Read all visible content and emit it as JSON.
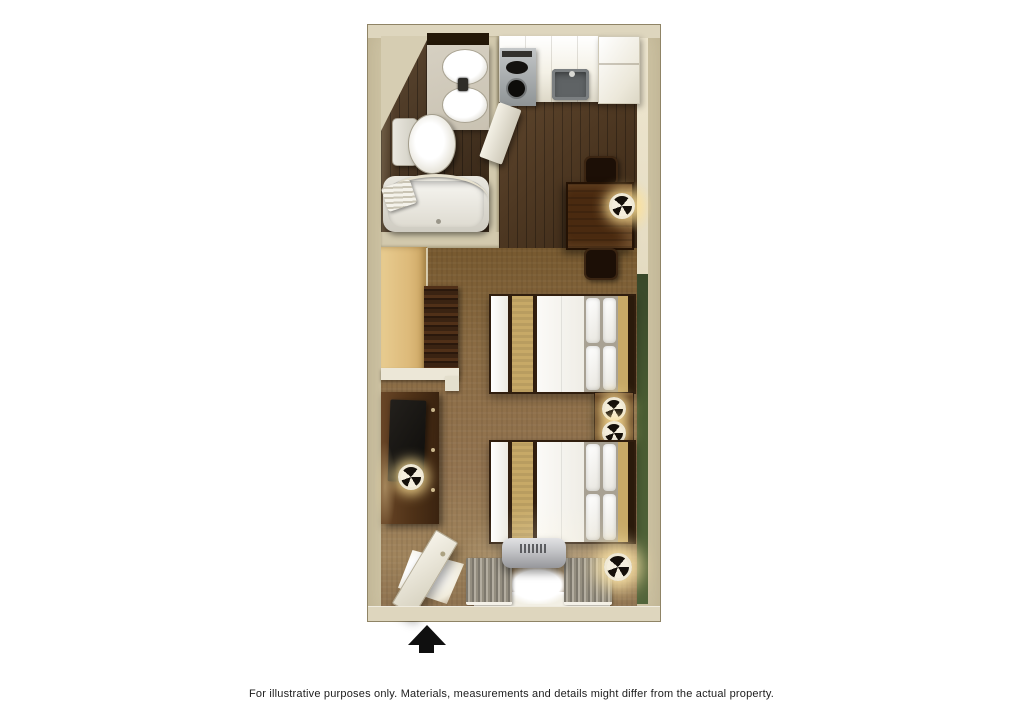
{
  "caption": {
    "text": "For illustrative purposes only.  Materials, measurements and details might differ from the actual property."
  },
  "colors": {
    "bg": "#ffffff",
    "wall": "#cfc5a6",
    "wall_top": "#ded6be",
    "wall_inner": "#e4dbc2",
    "wall_divider": "#d2c9ad",
    "green": "#4a5c32",
    "wood": "#53381e",
    "wood_bath": "#46301b",
    "carpet": "#8c6d45",
    "counter_gray": "#c9c2b2",
    "dark_furn": "#4e3117",
    "table_brown": "#4a2a10",
    "chair_dark": "#1c0f06",
    "closet_wood": "#ddba7a",
    "khaki": "#c7a967",
    "silver": "#c2c3c6",
    "arrow": "#0f0f0f",
    "text": "#1c1c1c"
  },
  "floorplan": {
    "type": "studio-suite-3d-floor-plan",
    "rooms": [
      {
        "name": "bathroom",
        "fixtures": [
          "vanity-sink",
          "mirror-reflection",
          "toilet",
          "bathtub",
          "shower-curtain-rod",
          "towel"
        ]
      },
      {
        "name": "kitchen",
        "fixtures": [
          "counter-cabinets",
          "stovetop-burners",
          "kitchen-sink",
          "refrigerator",
          "open-cabinet-door",
          "dining-table",
          "dining-chairs",
          "table-lamp"
        ]
      },
      {
        "name": "sleeping-living-area",
        "fixtures": [
          "open-closet",
          "hanging-clothes",
          "closet-shelf",
          "dresser",
          "television",
          "dresser-lamp",
          "bed-1",
          "bed-2",
          "nightstand",
          "nightstand-lamps",
          "floor-lamp",
          "ac-heating-unit",
          "window",
          "curtains",
          "entry-door"
        ]
      }
    ],
    "entry_indicator": "entrance-arrow"
  }
}
